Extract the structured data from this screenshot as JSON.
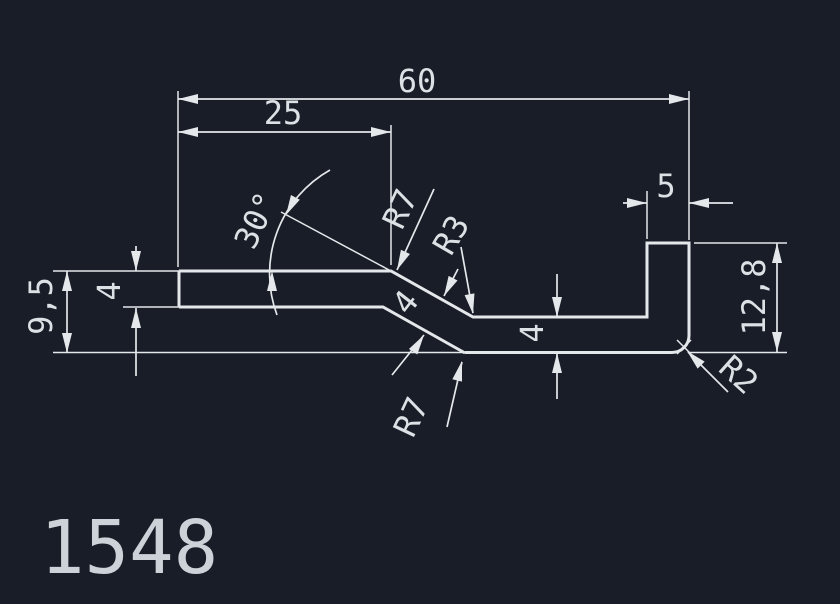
{
  "drawing": {
    "part_number": "1548",
    "dimensions": {
      "width_total": "60",
      "width_upper_flange": "25",
      "leg_width": "5",
      "height_overall": "9,5",
      "thickness_flange": "4",
      "thickness_slant": "4",
      "thickness_web": "4",
      "leg_height": "12,8",
      "slant_angle": "30°",
      "radius_upper_bend": "R7",
      "radius_inner_bend": "R3",
      "radius_lower_bend": "R7",
      "radius_corner": "R2"
    }
  },
  "colors": {
    "background": "#181d27",
    "linework": "#e4e8eb",
    "text": "#dce1e5"
  }
}
